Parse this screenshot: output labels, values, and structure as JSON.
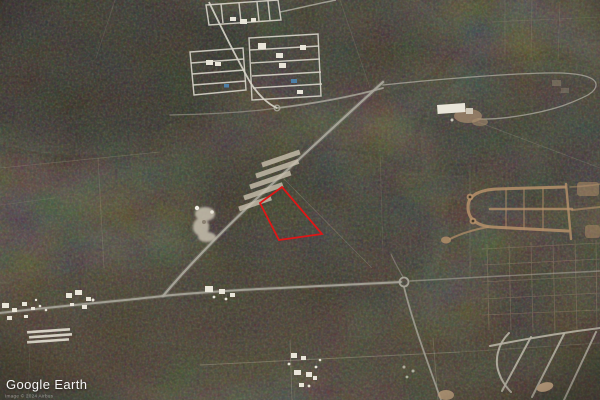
{
  "app": {
    "name": "Google Earth"
  },
  "watermark": {
    "logo": "Google Earth",
    "attribution": "Image © 2024 Airbus"
  },
  "map": {
    "kind": "satellite-aerial-imagery",
    "scene": "Dark scrub-forest aerial view crossed by dirt roads and faint parcel trails, with housing subdivisions and a red-outlined vacant land parcel at center",
    "parcel": {
      "name": "highlighted-land-parcel",
      "outline_points": "282,187 260,203 279,240 322,234",
      "outline_color": "#e01616"
    },
    "palette": {
      "forest_dark": "#232017",
      "forest_brown": "#3a2f23",
      "road_gray": "#a9a69b",
      "road_white": "#d6d3c8",
      "road_tan": "#b5916b",
      "pool_blue": "#4d7fa6",
      "building_white": "#e9e5d9",
      "strip_tan": "#c9c0ae",
      "clearing_white": "#cbc4b2"
    },
    "features": [
      "forest-canopy",
      "parcel-trail-grid",
      "grid-subdivision-northwest",
      "cleared-lot-strips",
      "white-clearing",
      "main-diagonal-road",
      "east-west-road",
      "roundabout",
      "service-road-loop",
      "white-building-complex",
      "c-shaped-street-development",
      "parcel-grid-southeast",
      "curved-street-development-southeast",
      "roadside-settlement-west",
      "roadside-settlement-center",
      "greenhouse-rows",
      "pond-clearing",
      "highlighted-land-parcel"
    ]
  }
}
